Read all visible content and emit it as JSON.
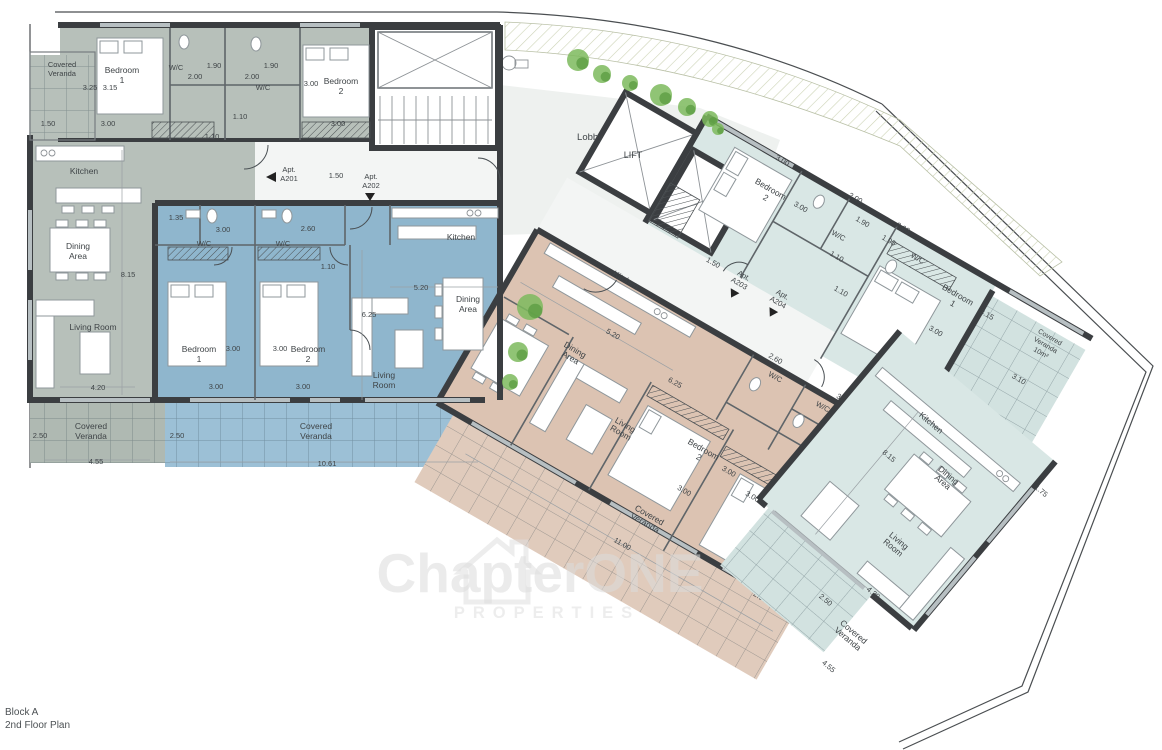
{
  "meta": {
    "block": "Block A",
    "floor": "2nd Floor Plan"
  },
  "watermark": {
    "brand": "ChapterONE",
    "sub": "PROPERTIES"
  },
  "colors": {
    "text": "#3f4447",
    "walls": "#3b3e41",
    "a201": "#b7c0ba",
    "a202": "#8fb6cd",
    "a203": "#dcc3b2",
    "a204": "#d9e7e5",
    "veranda_grey": "#afb9b2",
    "veranda_blue": "#9cc0d6",
    "veranda_tan": "#e0cbbc",
    "veranda_ltblue": "#d2e2e0",
    "lobby": "#eef1ef",
    "corridor": "#f3f5f4",
    "plant": "#7cba5d",
    "plant_dark": "#5d9e44",
    "watermark": "#dcdcdc"
  },
  "plants": [
    [
      578,
      60,
      11
    ],
    [
      602,
      74,
      9
    ],
    [
      630,
      83,
      8
    ],
    [
      661,
      95,
      11
    ],
    [
      687,
      107,
      9
    ],
    [
      710,
      119,
      8
    ],
    [
      718,
      129,
      6
    ],
    [
      530,
      307,
      13
    ],
    [
      518,
      352,
      10
    ],
    [
      510,
      382,
      8
    ]
  ],
  "labels": {
    "flat": [
      {
        "t": "Covered",
        "x": 62,
        "y": 67,
        "s": 7.5
      },
      {
        "t": "Veranda",
        "x": 62,
        "y": 76,
        "s": 7.5
      },
      {
        "t": "3.25",
        "x": 90,
        "y": 90,
        "s": 7.5
      },
      {
        "t": "3.15",
        "x": 110,
        "y": 90,
        "s": 7.5
      },
      {
        "t": "Bedroom",
        "x": 122,
        "y": 73
      },
      {
        "t": "1",
        "x": 122,
        "y": 83
      },
      {
        "t": "W/C",
        "x": 176,
        "y": 70,
        "s": 7.5
      },
      {
        "t": "2.00",
        "x": 195,
        "y": 79,
        "s": 7.5
      },
      {
        "t": "1.90",
        "x": 214,
        "y": 68,
        "s": 7.5
      },
      {
        "t": "2.00",
        "x": 252,
        "y": 79,
        "s": 7.5
      },
      {
        "t": "W/C",
        "x": 263,
        "y": 90,
        "s": 7.5
      },
      {
        "t": "1.90",
        "x": 271,
        "y": 68,
        "s": 7.5
      },
      {
        "t": "3.00",
        "x": 311,
        "y": 86,
        "s": 7.5
      },
      {
        "t": "Bedroom",
        "x": 341,
        "y": 84
      },
      {
        "t": "2",
        "x": 341,
        "y": 94
      },
      {
        "t": "1.50",
        "x": 48,
        "y": 126,
        "s": 7.5
      },
      {
        "t": "3.00",
        "x": 108,
        "y": 126,
        "s": 7.5
      },
      {
        "t": "1.10",
        "x": 240,
        "y": 119,
        "s": 7.5
      },
      {
        "t": "1.10",
        "x": 212,
        "y": 139,
        "s": 7.5
      },
      {
        "t": "3.00",
        "x": 338,
        "y": 126,
        "s": 7.5
      },
      {
        "t": "Apt.",
        "x": 289,
        "y": 172,
        "s": 7.5
      },
      {
        "t": "A201",
        "x": 289,
        "y": 181,
        "s": 7.5
      },
      {
        "t": "1.50",
        "x": 336,
        "y": 178,
        "s": 7.5
      },
      {
        "t": "Apt.",
        "x": 371,
        "y": 179,
        "s": 7.5
      },
      {
        "t": "A202",
        "x": 371,
        "y": 188,
        "s": 7.5
      },
      {
        "t": "Kitchen",
        "x": 84,
        "y": 174
      },
      {
        "t": "Dining",
        "x": 78,
        "y": 249
      },
      {
        "t": "Area",
        "x": 78,
        "y": 259
      },
      {
        "t": "8.15",
        "x": 128,
        "y": 277,
        "s": 7.5
      },
      {
        "t": "Living Room",
        "x": 93,
        "y": 330
      },
      {
        "t": "4.20",
        "x": 98,
        "y": 390,
        "s": 7.5
      },
      {
        "t": "Covered",
        "x": 91,
        "y": 429
      },
      {
        "t": "Veranda",
        "x": 91,
        "y": 439
      },
      {
        "t": "2.50",
        "x": 40,
        "y": 438,
        "s": 7.5
      },
      {
        "t": "4.55",
        "x": 96,
        "y": 464,
        "s": 7.5
      },
      {
        "t": "1.35",
        "x": 176,
        "y": 220,
        "s": 7.5
      },
      {
        "t": "3.00",
        "x": 223,
        "y": 232,
        "s": 7.5
      },
      {
        "t": "W/C",
        "x": 204,
        "y": 246,
        "s": 7.5
      },
      {
        "t": "W/C",
        "x": 283,
        "y": 246,
        "s": 7.5
      },
      {
        "t": "2.60",
        "x": 308,
        "y": 231,
        "s": 7.5
      },
      {
        "t": "1.10",
        "x": 328,
        "y": 269,
        "s": 7.5
      },
      {
        "t": "Bedroom",
        "x": 199,
        "y": 352
      },
      {
        "t": "1",
        "x": 199,
        "y": 362
      },
      {
        "t": "3.00",
        "x": 233,
        "y": 351,
        "s": 7.5
      },
      {
        "t": "3.00",
        "x": 280,
        "y": 351,
        "s": 7.5
      },
      {
        "t": "Bedroom",
        "x": 308,
        "y": 352
      },
      {
        "t": "2",
        "x": 308,
        "y": 362
      },
      {
        "t": "3.00",
        "x": 216,
        "y": 389,
        "s": 7.5
      },
      {
        "t": "3.00",
        "x": 303,
        "y": 389,
        "s": 7.5
      },
      {
        "t": "Living",
        "x": 384,
        "y": 378
      },
      {
        "t": "Room",
        "x": 384,
        "y": 388
      },
      {
        "t": "Kitchen",
        "x": 461,
        "y": 240
      },
      {
        "t": "5.20",
        "x": 421,
        "y": 290,
        "s": 7.5
      },
      {
        "t": "6.25",
        "x": 369,
        "y": 317,
        "s": 7.5
      },
      {
        "t": "Dining",
        "x": 468,
        "y": 302
      },
      {
        "t": "Area",
        "x": 468,
        "y": 312
      },
      {
        "t": "Covered",
        "x": 316,
        "y": 429
      },
      {
        "t": "Veranda",
        "x": 316,
        "y": 439
      },
      {
        "t": "2.50",
        "x": 177,
        "y": 438,
        "s": 7.5
      },
      {
        "t": "10.61",
        "x": 327,
        "y": 466,
        "s": 7.5
      },
      {
        "t": "Lobby",
        "x": 590,
        "y": 140,
        "s": 9.5
      },
      {
        "t": "LIFT",
        "x": 633,
        "y": 158,
        "s": 9
      },
      {
        "t": "ChapterONE",
        "x": 540,
        "y": 592,
        "s": 55,
        "fw": 700,
        "c": "#dcdcdc",
        "o": 0.55,
        "a": "start"
      },
      {
        "t": "PROPERTIES",
        "x": 547,
        "y": 618,
        "s": 16.5,
        "fw": 700,
        "c": "#e2e2e2",
        "o": 0.6,
        "ls": 8,
        "a": "start"
      }
    ],
    "r1": [
      {
        "t": "3.00",
        "x": 778,
        "y": 45,
        "s": 7.5
      },
      {
        "t": "Bedroom",
        "x": 782,
        "y": 76
      },
      {
        "t": "2",
        "x": 782,
        "y": 86
      },
      {
        "t": "3.00",
        "x": 817,
        "y": 76,
        "s": 7.5
      },
      {
        "t": "2.00",
        "x": 860,
        "y": 41,
        "s": 7.5
      },
      {
        "t": "1.90",
        "x": 878,
        "y": 58,
        "s": 7.5
      },
      {
        "t": "W/C",
        "x": 864,
        "y": 82,
        "s": 7.5
      },
      {
        "t": "1.90",
        "x": 910,
        "y": 61,
        "s": 7.5
      },
      {
        "t": "2.00",
        "x": 916,
        "y": 43,
        "s": 7.5
      },
      {
        "t": "W/C",
        "x": 944,
        "y": 62,
        "s": 7.5
      },
      {
        "t": "Bedroom",
        "x": 997,
        "y": 74
      },
      {
        "t": "1",
        "x": 997,
        "y": 84
      },
      {
        "t": "3.15",
        "x": 1032,
        "y": 76,
        "s": 7.5
      },
      {
        "t": "3.00",
        "x": 996,
        "y": 116,
        "s": 7.5
      },
      {
        "t": "Covered",
        "x": 1098,
        "y": 64,
        "s": 7
      },
      {
        "t": "Veranda",
        "x": 1098,
        "y": 73,
        "s": 7
      },
      {
        "t": "10m²",
        "x": 1098,
        "y": 82,
        "s": 7
      },
      {
        "t": "3.10",
        "x": 1092,
        "y": 116,
        "s": 7.5
      },
      {
        "t": "1.10",
        "x": 873,
        "y": 101,
        "s": 7.5
      },
      {
        "t": "1.10",
        "x": 894,
        "y": 129,
        "s": 7.5
      },
      {
        "t": "1.50",
        "x": 769,
        "y": 168,
        "s": 7.5
      },
      {
        "t": "Apt.",
        "x": 802,
        "y": 164,
        "s": 7.5
      },
      {
        "t": "A203",
        "x": 802,
        "y": 173,
        "s": 7.5
      },
      {
        "t": "Apt.",
        "x": 845,
        "y": 161,
        "s": 7.5
      },
      {
        "t": "A204",
        "x": 845,
        "y": 170,
        "s": 7.5
      },
      {
        "t": "Kitchen",
        "x": 702,
        "y": 227
      },
      {
        "t": "5.20",
        "x": 718,
        "y": 280,
        "s": 7.5
      },
      {
        "t": "Dining",
        "x": 693,
        "y": 313
      },
      {
        "t": "Area",
        "x": 693,
        "y": 322
      },
      {
        "t": "6.25",
        "x": 796,
        "y": 291,
        "s": 7.5
      },
      {
        "t": "Living",
        "x": 774,
        "y": 353
      },
      {
        "t": "Room",
        "x": 774,
        "y": 362
      },
      {
        "t": "Bedroom",
        "x": 854,
        "y": 335
      },
      {
        "t": "2",
        "x": 854,
        "y": 344
      },
      {
        "t": "3.00",
        "x": 858,
        "y": 380,
        "s": 7.5
      },
      {
        "t": "3.00",
        "x": 887,
        "y": 341,
        "s": 7.5
      },
      {
        "t": "Bedroom",
        "x": 958,
        "y": 347
      },
      {
        "t": "1",
        "x": 958,
        "y": 356
      },
      {
        "t": "3.00",
        "x": 920,
        "y": 351,
        "s": 7.5
      },
      {
        "t": "3.00",
        "x": 958,
        "y": 396,
        "s": 7.5
      },
      {
        "t": "W/C",
        "x": 880,
        "y": 236,
        "s": 7.5
      },
      {
        "t": "2.60",
        "x": 871,
        "y": 220,
        "s": 7.5
      },
      {
        "t": "W/C",
        "x": 936,
        "y": 238,
        "s": 7.5
      },
      {
        "t": "3.00",
        "x": 950,
        "y": 221,
        "s": 7.5
      },
      {
        "t": "W/C",
        "x": 963,
        "y": 256,
        "s": 7.5
      },
      {
        "t": "1.35",
        "x": 987,
        "y": 211,
        "s": 7.5
      },
      {
        "t": "Covered",
        "x": 840,
        "y": 419
      },
      {
        "t": "Veranda",
        "x": 840,
        "y": 428
      },
      {
        "t": "11.00",
        "x": 831,
        "y": 457,
        "s": 7.5
      },
      {
        "t": "2.50",
        "x": 977,
        "y": 434,
        "s": 7.5
      }
    ],
    "r2": [
      {
        "t": "Kitchen",
        "x": 945,
        "y": 398
      },
      {
        "t": "8.15",
        "x": 934,
        "y": 450,
        "s": 7.5
      },
      {
        "t": "Dining",
        "x": 992,
        "y": 427
      },
      {
        "t": "Area",
        "x": 992,
        "y": 436
      },
      {
        "t": "Living",
        "x": 996,
        "y": 509
      },
      {
        "t": "Room",
        "x": 996,
        "y": 518
      },
      {
        "t": "4.20",
        "x": 1010,
        "y": 565,
        "s": 7.5
      },
      {
        "t": "Covered",
        "x": 1020,
        "y": 608
      },
      {
        "t": "Veranda",
        "x": 1020,
        "y": 617
      },
      {
        "t": "2.50",
        "x": 978,
        "y": 601,
        "s": 7.5
      },
      {
        "t": "4.55",
        "x": 1023,
        "y": 650,
        "s": 7.5
      },
      {
        "t": "1.75",
        "x": 1073,
        "y": 379,
        "s": 7.5
      }
    ]
  }
}
